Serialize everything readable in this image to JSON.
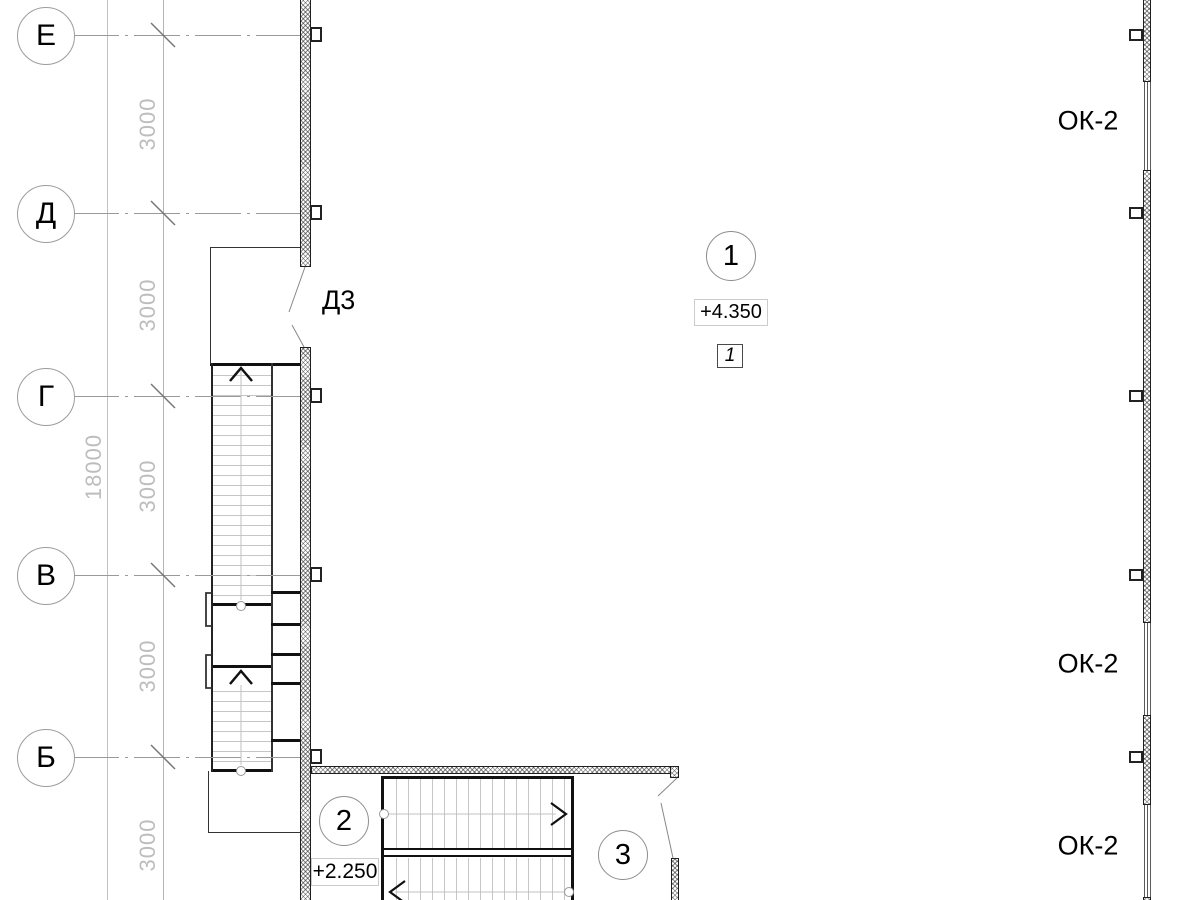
{
  "axis_labels": {
    "e": "Е",
    "d": "Д",
    "g": "Г",
    "v": "В",
    "b": "Б"
  },
  "dimensions": {
    "overall": "18000",
    "bay": "3000"
  },
  "door_label": "Д3",
  "window_label": "ОК-2",
  "levels": {
    "upper": "+4.350",
    "lower": "+2.250"
  },
  "markers": {
    "marker_1": "1",
    "marker_2": "2",
    "marker_3": "3",
    "node_1": "1"
  },
  "colors": {
    "line_dark": "#111111",
    "line_gray": "#9a9a9a",
    "dim_text": "#bdbdbd"
  }
}
